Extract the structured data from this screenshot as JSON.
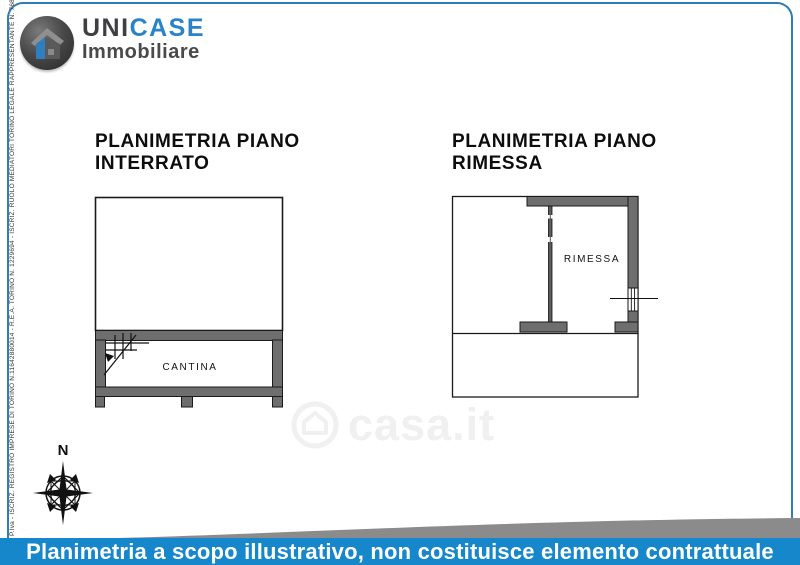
{
  "brand": {
    "name_prefix": "UNI",
    "name_suffix": "CASE",
    "subtitle": "Immobiliare",
    "icon": "house-in-circle-icon"
  },
  "side_note": "P.Iva - ISCRIZ. REGISTRO IMPRESE DI TORINO N.11642880014 - R.E.A. TORINO N. 1229694 - ISCRIZ. RUOLO MEDIATORI TORINO LEGALE RAPPRESENTANTE N. 7686",
  "plans": {
    "left": {
      "title_line1": "PLANIMETRIA PIANO",
      "title_line2": "INTERRATO",
      "room_label": "CANTINA",
      "features": [
        "staircase-symbol",
        "two-wall-openings-bottom"
      ]
    },
    "right": {
      "title_line1": "PLANIMETRIA PIANO",
      "title_line2": "RIMESSA",
      "room_label": "RIMESSA",
      "features": [
        "window-symbol-right-wall",
        "thin-partition-wall"
      ]
    }
  },
  "compass": {
    "north_label": "N",
    "icon": "compass-rose-icon"
  },
  "watermark": {
    "text": "casa.it",
    "icon": "casa-house-logo-icon"
  },
  "footer": {
    "disclaimer": "Planimetria a scopo illustrativo, non costituisce elemento contrattuale"
  },
  "colors": {
    "banner_blue": "#1787cb",
    "frame_blue": "#2e7db6",
    "brand_blue": "#2a82c9",
    "brand_dark": "#3f3f41",
    "wall_gray": "#6e6e6e",
    "swoosh_gray": "#8b8b8b",
    "watermark_gray": "#f0f0f0"
  }
}
